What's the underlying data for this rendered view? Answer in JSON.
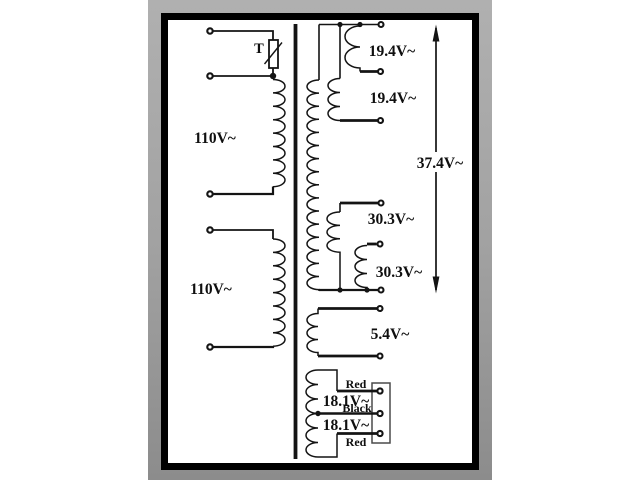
{
  "diagram": {
    "type": "transformer wiring schematic",
    "primary": {
      "winding1_label": "110V~",
      "winding2_label": "110V~",
      "thermal_fuse_label": "T"
    },
    "secondary": {
      "winding_19_top_label": "19.4V~",
      "winding_19_bottom_label": "19.4V~",
      "series_total_label": "37.4V~",
      "winding_30_top_label": "30.3V~",
      "winding_30_bottom_label": "30.3V~",
      "winding_5_label": "5.4V~",
      "winding_18_top_label": "18.1V~",
      "winding_18_bottom_label": "18.1V~",
      "lead_red_top_label": "Red",
      "lead_black_label": "Black",
      "lead_red_bottom_label": "Red"
    },
    "colors": {
      "ink": "#141414",
      "paper": "#ffffff",
      "backdrop_top": "#b0b0b0",
      "backdrop_bottom": "#8c8c8c"
    }
  }
}
